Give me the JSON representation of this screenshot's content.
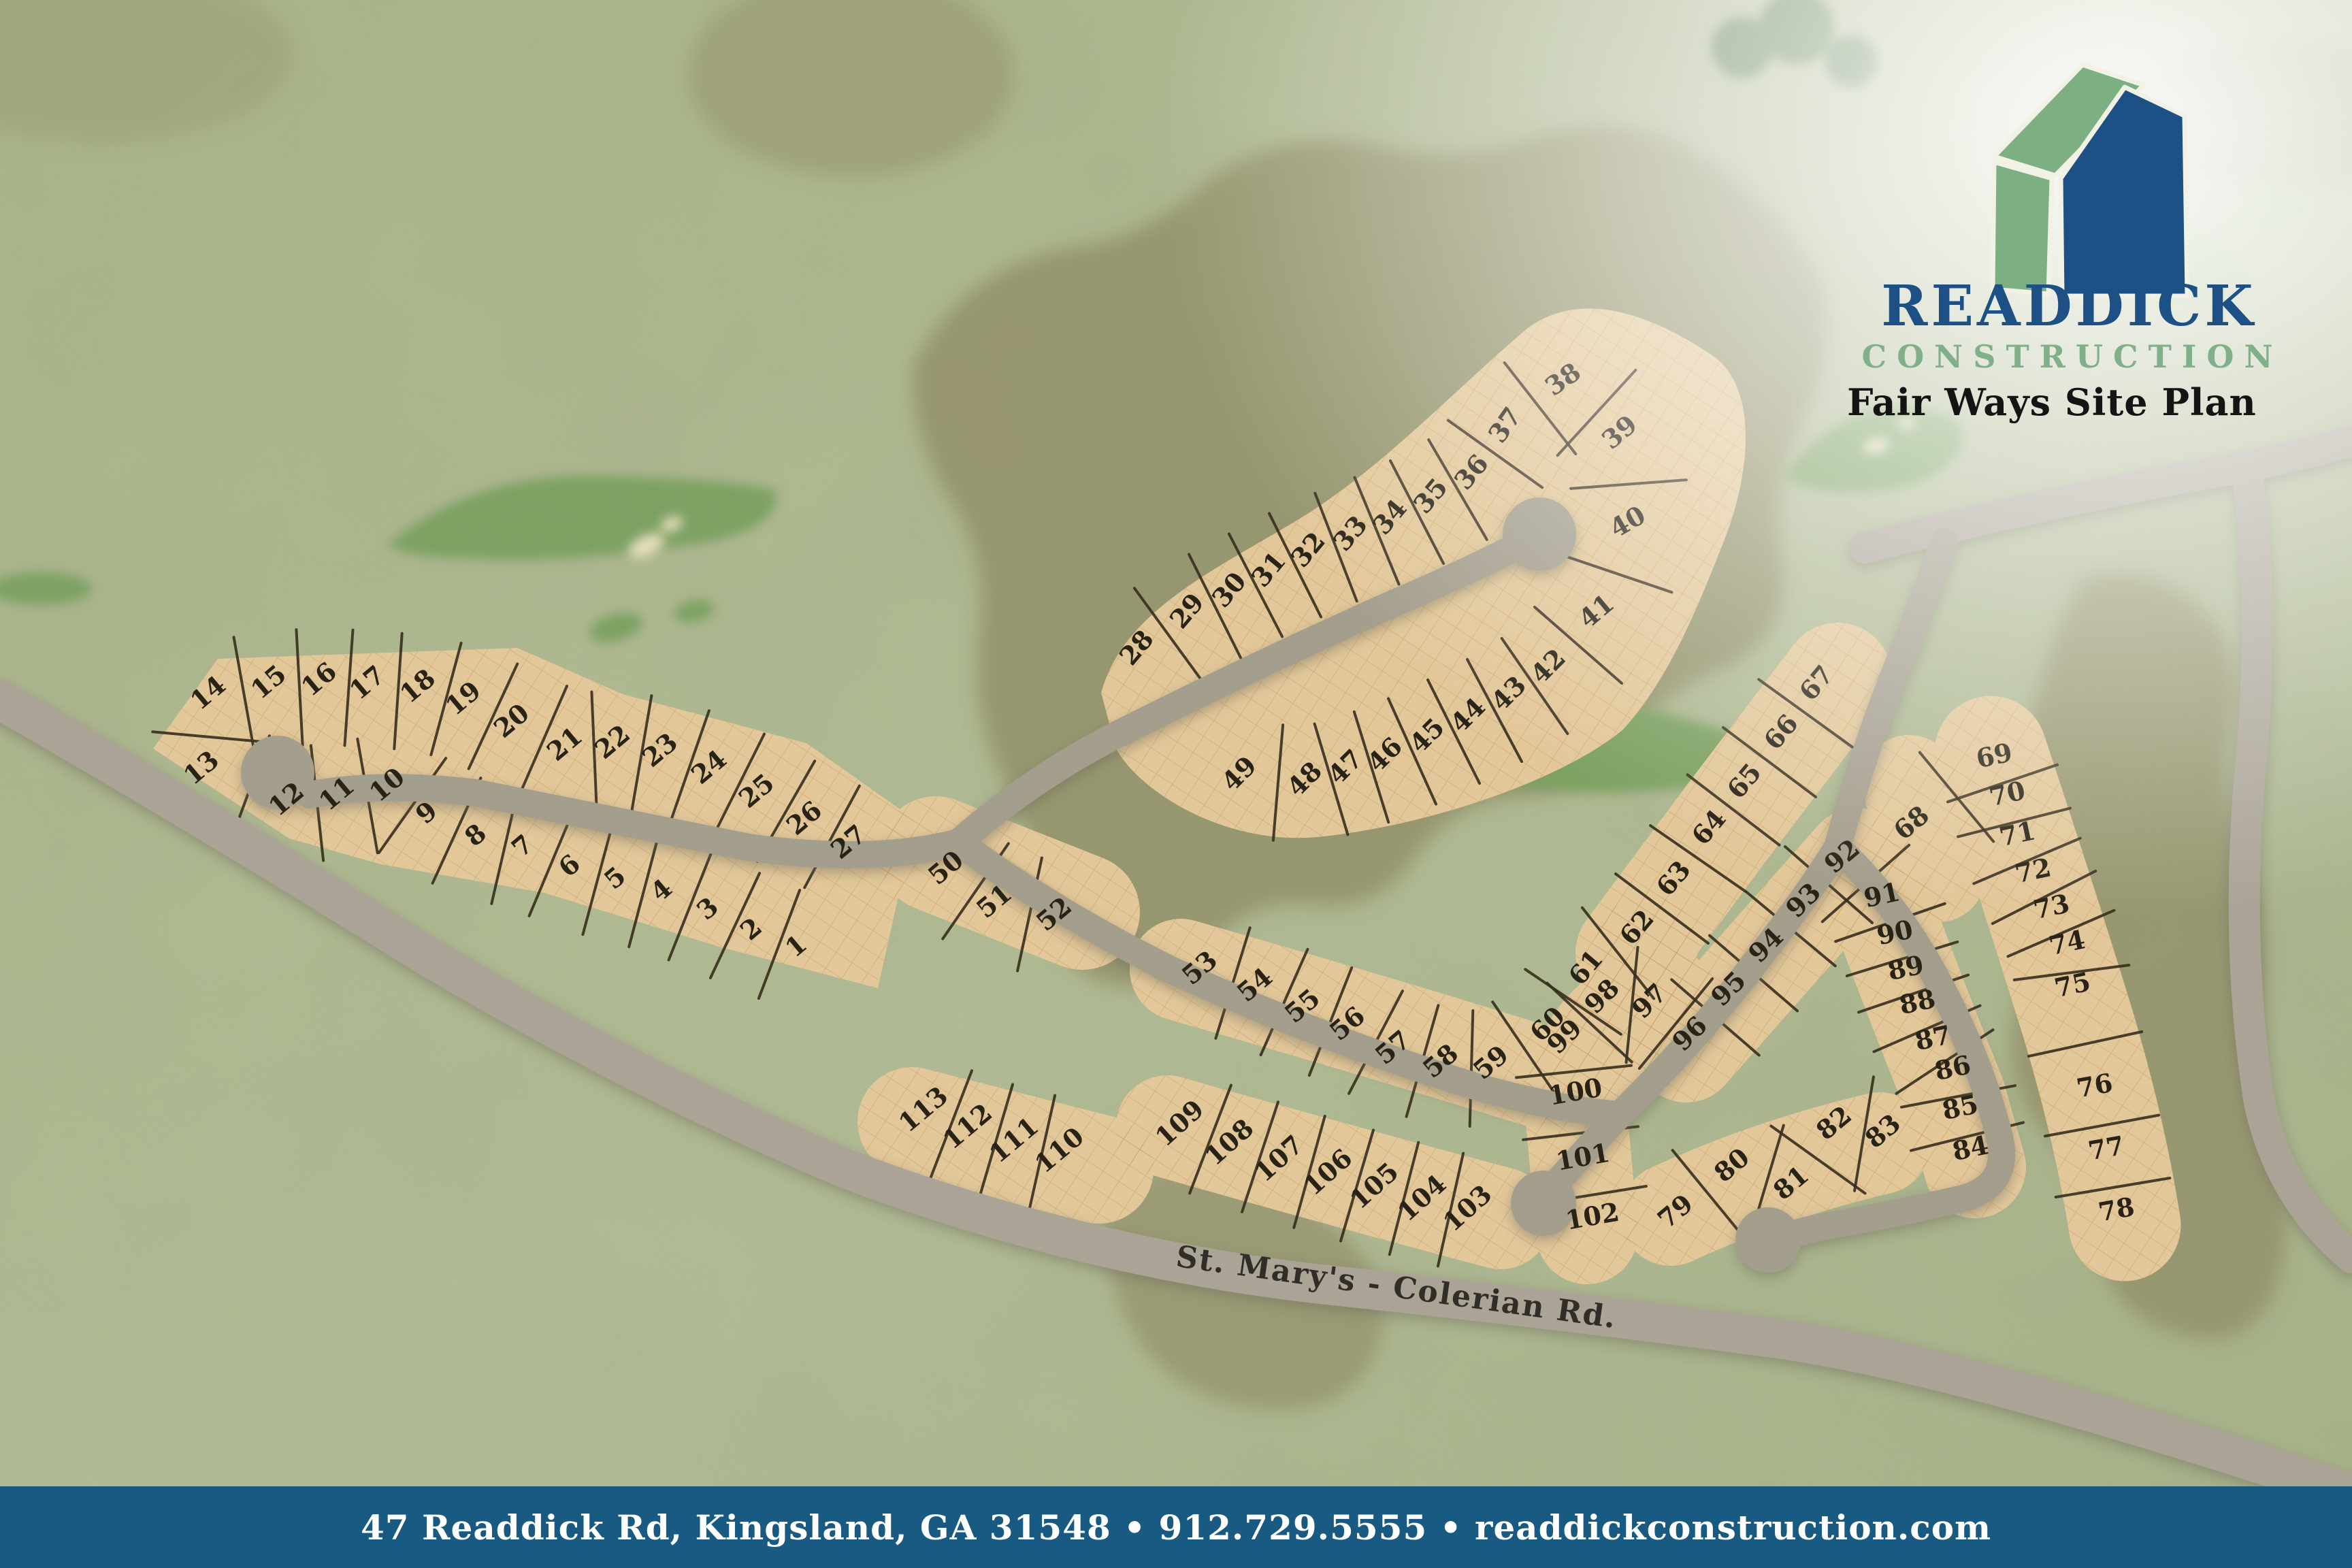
{
  "branding": {
    "company_name_top": "READDICK",
    "company_name_bottom": "CONSTRUCTION",
    "plan_title": "Fair Ways Site Plan",
    "logo_icon": "house-icon"
  },
  "footer": {
    "text": "47 Readdick Rd, Kingsland, GA 31548 • 912.729.5555 • readdickconstruction.com"
  },
  "map": {
    "road_label": "St. Mary's - Colerian Rd.",
    "colors": {
      "background": "#b7c29b",
      "parcel": "#ecd0a0",
      "parcel_hatch": "#c89f63",
      "road": "#aba593",
      "major_road": "#b2ab9d",
      "divider": "#3a3020",
      "lot_text": "#2b2518",
      "fairway_green": "#83a868",
      "olive": "#99966e",
      "footer_bg": "#185a81",
      "logo_blue": "#1d5185",
      "logo_green": "#7fb08a"
    },
    "lots_format": "[lot_number, x, y, rotation_deg]",
    "lots": [
      [
        1,
        1178,
        1400,
        -40
      ],
      [
        2,
        1112,
        1375,
        -40
      ],
      [
        3,
        1048,
        1345,
        -40
      ],
      [
        4,
        980,
        1318,
        -40
      ],
      [
        5,
        912,
        1300,
        -40
      ],
      [
        6,
        845,
        1282,
        -40
      ],
      [
        7,
        776,
        1253,
        -40
      ],
      [
        8,
        707,
        1237,
        -40
      ],
      [
        9,
        635,
        1204,
        -40
      ],
      [
        10,
        577,
        1163,
        -40
      ],
      [
        11,
        503,
        1176,
        -40
      ],
      [
        12,
        429,
        1184,
        -40
      ],
      [
        13,
        304,
        1138,
        -40
      ],
      [
        14,
        314,
        1028,
        -40
      ],
      [
        15,
        403,
        1012,
        -40
      ],
      [
        16,
        477,
        1008,
        -40
      ],
      [
        17,
        548,
        1013,
        -40
      ],
      [
        18,
        622,
        1018,
        -40
      ],
      [
        19,
        689,
        1036,
        -40
      ],
      [
        20,
        760,
        1069,
        -40
      ],
      [
        21,
        838,
        1103,
        -40
      ],
      [
        22,
        908,
        1100,
        -40
      ],
      [
        23,
        978,
        1112,
        -40
      ],
      [
        24,
        1050,
        1137,
        -40
      ],
      [
        25,
        1120,
        1172,
        -40
      ],
      [
        26,
        1190,
        1212,
        -40
      ],
      [
        27,
        1255,
        1247,
        -40
      ],
      [
        28,
        1680,
        960,
        -50
      ],
      [
        29,
        1754,
        906,
        -50
      ],
      [
        30,
        1816,
        875,
        -50
      ],
      [
        31,
        1874,
        845,
        -50
      ],
      [
        32,
        1932,
        816,
        -50
      ],
      [
        33,
        1994,
        792,
        -50
      ],
      [
        34,
        2052,
        768,
        -50
      ],
      [
        35,
        2112,
        737,
        -50
      ],
      [
        36,
        2172,
        702,
        -50
      ],
      [
        37,
        2222,
        632,
        -55
      ],
      [
        38,
        2304,
        568,
        -35
      ],
      [
        39,
        2388,
        645,
        -40
      ],
      [
        40,
        2398,
        778,
        -30
      ],
      [
        41,
        2354,
        908,
        -40
      ],
      [
        42,
        2284,
        988,
        -45
      ],
      [
        43,
        2226,
        1028,
        -45
      ],
      [
        44,
        2166,
        1060,
        -45
      ],
      [
        45,
        2106,
        1090,
        -45
      ],
      [
        46,
        2044,
        1118,
        -45
      ],
      [
        47,
        1986,
        1136,
        -45
      ],
      [
        48,
        1926,
        1154,
        -45
      ],
      [
        49,
        1830,
        1146,
        -45
      ],
      [
        50,
        1398,
        1285,
        -40
      ],
      [
        51,
        1469,
        1334,
        -40
      ],
      [
        52,
        1557,
        1353,
        -40
      ],
      [
        53,
        1771,
        1432,
        -40
      ],
      [
        54,
        1852,
        1457,
        -40
      ],
      [
        55,
        1922,
        1488,
        -40
      ],
      [
        56,
        1988,
        1514,
        -40
      ],
      [
        57,
        2055,
        1549,
        -40
      ],
      [
        58,
        2125,
        1569,
        -40
      ],
      [
        59,
        2199,
        1571,
        -40
      ],
      [
        60,
        2283,
        1514,
        -45
      ],
      [
        61,
        2340,
        1430,
        -50
      ],
      [
        62,
        2415,
        1371,
        -50
      ],
      [
        63,
        2469,
        1299,
        -50
      ],
      [
        64,
        2521,
        1224,
        -50
      ],
      [
        65,
        2573,
        1156,
        -50
      ],
      [
        66,
        2627,
        1084,
        -50
      ],
      [
        67,
        2679,
        1012,
        -50
      ],
      [
        68,
        2817,
        1219,
        -40
      ],
      [
        69,
        2933,
        1123,
        -12
      ],
      [
        70,
        2952,
        1179,
        -12
      ],
      [
        71,
        2967,
        1238,
        -12
      ],
      [
        72,
        2990,
        1292,
        -12
      ],
      [
        73,
        3017,
        1345,
        -12
      ],
      [
        74,
        3040,
        1398,
        -12
      ],
      [
        75,
        3048,
        1460,
        -12
      ],
      [
        76,
        3080,
        1608,
        -10
      ],
      [
        77,
        3097,
        1700,
        -10
      ],
      [
        78,
        3112,
        1790,
        -10
      ],
      [
        79,
        2470,
        1790,
        -40
      ],
      [
        80,
        2553,
        1722,
        -40
      ],
      [
        81,
        2640,
        1748,
        -40
      ],
      [
        82,
        2703,
        1660,
        -40
      ],
      [
        83,
        2775,
        1672,
        -40
      ],
      [
        84,
        2898,
        1700,
        -12
      ],
      [
        85,
        2883,
        1640,
        -12
      ],
      [
        86,
        2872,
        1582,
        -12
      ],
      [
        87,
        2843,
        1538,
        -12
      ],
      [
        88,
        2820,
        1485,
        -12
      ],
      [
        89,
        2803,
        1435,
        -12
      ],
      [
        90,
        2787,
        1383,
        -12
      ],
      [
        91,
        2768,
        1328,
        -12
      ],
      [
        92,
        2715,
        1268,
        -40
      ],
      [
        93,
        2659,
        1332,
        -45
      ],
      [
        94,
        2604,
        1398,
        -45
      ],
      [
        95,
        2549,
        1462,
        -45
      ],
      [
        96,
        2492,
        1528,
        -45
      ],
      [
        97,
        2433,
        1480,
        -45
      ],
      [
        98,
        2363,
        1473,
        -45
      ],
      [
        99,
        2308,
        1532,
        -45
      ],
      [
        100,
        2317,
        1617,
        -10
      ],
      [
        101,
        2328,
        1713,
        -10
      ],
      [
        102,
        2342,
        1800,
        -10
      ],
      [
        103,
        2165,
        1785,
        -42
      ],
      [
        104,
        2098,
        1770,
        -42
      ],
      [
        105,
        2028,
        1752,
        -42
      ],
      [
        106,
        1960,
        1732,
        -42
      ],
      [
        107,
        1888,
        1712,
        -42
      ],
      [
        108,
        1815,
        1688,
        -42
      ],
      [
        109,
        1742,
        1660,
        -42
      ],
      [
        110,
        1565,
        1700,
        -40
      ],
      [
        111,
        1498,
        1685,
        -40
      ],
      [
        112,
        1430,
        1665,
        -40
      ],
      [
        113,
        1365,
        1640,
        -40
      ]
    ],
    "lot_strips_for_dividers": [
      [
        14,
        13
      ],
      [
        14,
        15,
        16,
        17,
        18,
        19,
        20,
        21,
        22,
        23,
        24,
        25,
        26,
        27
      ],
      [
        13,
        12,
        11,
        10,
        9,
        8,
        7,
        6,
        5,
        4,
        3,
        2,
        1
      ],
      [
        28,
        29,
        30,
        31,
        32,
        33,
        34,
        35,
        36,
        37,
        38
      ],
      [
        38,
        39,
        40,
        41,
        42
      ],
      [
        49,
        48,
        47,
        46,
        45,
        44,
        43,
        42
      ],
      [
        50,
        51,
        52
      ],
      [
        113,
        112,
        111,
        110
      ],
      [
        53,
        54,
        55,
        56,
        57,
        58,
        59,
        60,
        61
      ],
      [
        61,
        62,
        63,
        64,
        65,
        66,
        67
      ],
      [
        109,
        108,
        107,
        106,
        105,
        104,
        103
      ],
      [
        68,
        69,
        70,
        71,
        72,
        73,
        74,
        75,
        76,
        77,
        78
      ],
      [
        92,
        93,
        94,
        95,
        96
      ],
      [
        96,
        97,
        98,
        99,
        100,
        101,
        102
      ],
      [
        92,
        91,
        90,
        89,
        88,
        87,
        86,
        85,
        84
      ],
      [
        79,
        80,
        81,
        82,
        83
      ]
    ]
  }
}
